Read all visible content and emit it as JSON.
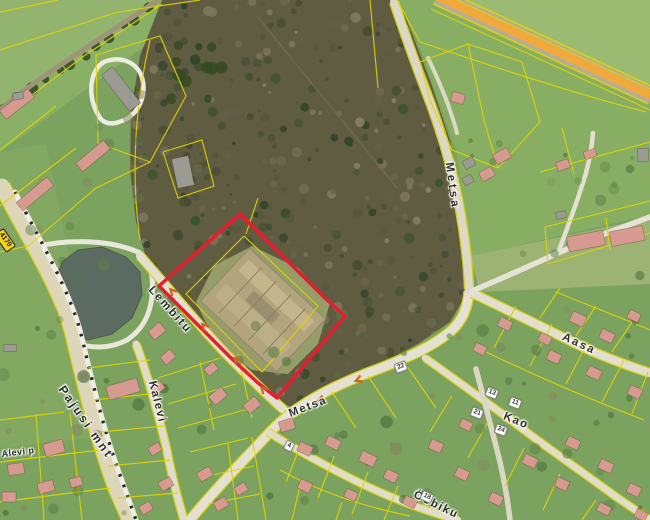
{
  "colors": {
    "base": "#7ba25e",
    "forest": "#5f5c42",
    "pond": "#5c6b62",
    "cadastral": "#e0d400",
    "highlight": "#ea1b2d",
    "road": "#e2dfd0",
    "hwy_orange": "#f1a93c",
    "house": "#d79a90",
    "barn": "#9b9b93"
  },
  "street_labels": [
    {
      "text": "Lembitu",
      "x": 170,
      "y": 310,
      "rot": 48,
      "ls": 2
    },
    {
      "text": "Kalevi",
      "x": 157,
      "y": 402,
      "rot": 76,
      "ls": 1.5
    },
    {
      "text": "Pajusi mnt",
      "x": 86,
      "y": 422,
      "rot": 55,
      "ls": 2.5,
      "fs": 12
    },
    {
      "text": "Metsa",
      "x": 452,
      "y": 186,
      "rot": 82,
      "ls": 3
    },
    {
      "text": "Metsa",
      "x": 308,
      "y": 407,
      "rot": -21,
      "ls": 1.5
    },
    {
      "text": "Aasa",
      "x": 579,
      "y": 344,
      "rot": 25,
      "ls": 2
    },
    {
      "text": "Kao",
      "x": 516,
      "y": 421,
      "rot": 22,
      "ls": 1.5
    },
    {
      "text": "Ööbiku",
      "x": 436,
      "y": 505,
      "rot": 26,
      "ls": 1.5
    },
    {
      "text": "Alevi p",
      "x": 18,
      "y": 452,
      "rot": -7,
      "ls": 0.5,
      "fs": 9
    }
  ],
  "road_shield": {
    "text": "4170",
    "x": 5,
    "y": 240,
    "rot": 55
  },
  "house_numbers": [
    {
      "text": "22",
      "x": 401,
      "y": 367,
      "rot": -20
    },
    {
      "text": "13",
      "x": 492,
      "y": 393,
      "rot": 20
    },
    {
      "text": "11",
      "x": 515,
      "y": 403,
      "rot": 20
    },
    {
      "text": "21",
      "x": 477,
      "y": 413,
      "rot": 20
    },
    {
      "text": "24",
      "x": 501,
      "y": 430,
      "rot": 20
    },
    {
      "text": "18",
      "x": 427,
      "y": 497,
      "rot": 25
    },
    {
      "text": "4",
      "x": 289,
      "y": 446,
      "rot": 25
    }
  ],
  "highlighted_parcel": {
    "outline_color": "#ea1b2d",
    "points": "240,214 327,300 345,316 277,398 258,383 231,358 181,308 159,286"
  },
  "geometry": {
    "forest": "162,0 398,0 410,28 432,86 450,140 462,205 468,255 470,288 450,322 418,344 384,362 348,377 314,394 292,407 280,403 262,388 234,361 182,308 158,284 146,258 136,222 130,170 131,112 140,56",
    "pond": "62,262 78,250 102,247 126,257 140,272 142,295 132,318 112,334 88,340 68,332 57,312 54,285",
    "clearing": "196,302 214,266 252,246 298,268 330,303 318,344 288,374 252,370 216,344",
    "ruin": {
      "cx": 263,
      "cy": 310,
      "rot": 43
    },
    "hwy": "M 437,-4 L 652,96",
    "pajusi_dash": "M 15,192 C 42,244 68,288 80,330 C 90,370 102,428 124,486 L 136,520",
    "fields": [
      {
        "pts": "0,0 160,0 122,34 60,70 0,106",
        "fill": "#93b46e"
      },
      {
        "pts": "0,106 60,70 122,34 160,0 204,0 150,42 88,88 28,132 0,152",
        "fill": "#8ab066"
      },
      {
        "pts": "398,0 650,0 650,215 472,256 456,150 420,48",
        "fill": "#87ae63"
      },
      {
        "pts": "441,0 650,0 650,94",
        "fill": "#9abb71"
      },
      {
        "pts": "470,256 650,218 650,284 480,292",
        "fill": "#9db373"
      },
      {
        "pts": "0,152 46,144 84,330 92,380 104,436 0,448",
        "fill": "#83a861"
      }
    ],
    "roads": [
      {
        "id": "pond-loop",
        "d": "M 28,248 C 70,238 110,240 138,252 C 150,258 154,276 152,296 C 150,316 142,330 127,340 C 110,349 90,349 74,342",
        "w": 5,
        "c": "#e9e6da"
      },
      {
        "id": "track-topleft",
        "d": "M 158,0 L 80,52 C 50,72 20,92 0,110",
        "w": 5,
        "c": "#9e9478"
      },
      {
        "id": "barn-loop",
        "d": "M 100,118 C 86,96 90,70 104,62 C 120,55 140,62 143,82 C 146,102 134,118 119,122 C 110,125 104,123 100,118",
        "w": 4.5,
        "c": "#eeece2"
      },
      {
        "id": "pajusi-mnt",
        "d": "M 2,186 C 30,240 60,286 72,330 C 82,370 94,428 116,488 L 130,520",
        "w": 15,
        "c": "#ddd6b8",
        "u": 1
      },
      {
        "id": "pajusi-path",
        "d": "M 15,192 C 42,244 68,288 80,330 C 90,370 102,428 124,486 L 136,520",
        "w": 5,
        "c": "#f0eee4"
      },
      {
        "id": "lembitu",
        "d": "M 140,256 C 162,280 192,318 226,354 C 250,378 266,394 284,410",
        "w": 8,
        "c": "#e2dfd0",
        "u": 1
      },
      {
        "id": "kalevi",
        "d": "M 136,344 C 146,370 156,406 166,446 C 172,478 178,500 184,520",
        "w": 7,
        "c": "#dfdccb",
        "u": 1
      },
      {
        "id": "metsa-south",
        "d": "M 190,520 C 218,486 246,458 272,430 C 298,404 330,388 365,374 C 400,361 432,348 452,330 C 463,320 468,306 469,291",
        "w": 9,
        "c": "#e4e1d2",
        "u": 1
      },
      {
        "id": "metsa-north",
        "d": "M 394,2 C 402,26 414,60 427,94 C 440,128 451,164 458,199 C 464,230 468,262 469,289",
        "w": 8,
        "c": "#dcd8c6",
        "u": 1
      },
      {
        "id": "aasa",
        "d": "M 472,293 C 510,311 550,331 589,350 C 612,360 632,367 650,373",
        "w": 8,
        "c": "#e2dfd0",
        "u": 1
      },
      {
        "id": "kao",
        "d": "M 425,358 C 452,377 482,399 512,421 C 546,447 581,471 615,496 C 628,505 640,513 650,520",
        "w": 6.5,
        "c": "#e0ddcd",
        "u": 1
      },
      {
        "id": "kao-cross",
        "d": "M 476,369 C 483,396 492,430 500,462 C 505,484 508,502 510,520",
        "w": 5.5,
        "c": "#dbd7c5"
      },
      {
        "id": "oobiku",
        "d": "M 268,432 C 292,447 320,463 350,478 C 385,496 425,511 458,520",
        "w": 6.5,
        "c": "#e0ddcd",
        "u": 1
      },
      {
        "id": "rightmid",
        "d": "M 472,291 C 500,279 530,266 558,253 C 590,239 620,228 650,217",
        "w": 5.5,
        "c": "#e6e3d6"
      },
      {
        "id": "rightmid-stub",
        "d": "M 558,253 C 568,226 578,200 586,173 C 590,158 592,146 593,133",
        "w": 4.5,
        "c": "#e3e0d2"
      },
      {
        "id": "ne-drive",
        "d": "M 428,58 C 441,85 451,110 457,133",
        "w": 4,
        "c": "#ddd9c8"
      }
    ],
    "parcel_lines": [
      "M 0,50 L 118,12 L 200,0",
      "M 0,12 L 58,0",
      "M 96,55 L 160,36 L 186,96 L 150,162 L 98,143 L 96,55",
      "M 163,152 L 202,140 L 214,186 L 178,198 L 163,152",
      "M 0,150 L 56,106",
      "M 0,206 L 76,148",
      "M 28,246 L 96,188 L 150,162",
      "M 0,252 L 28,246",
      "M 150,40 C 136,100 130,170 140,240",
      "M 162,4 L 84,56 L 4,116",
      "M 420,42 C 492,66 562,90 646,112",
      "M 398,2 L 420,42",
      "M 431,9 L 650,110",
      "M 444,-6 L 650,89",
      "M 545,227 L 650,201",
      "M 548,264 L 650,233",
      "M 545,227 L 548,264",
      "M 606,218 L 610,250",
      "M 540,172 L 650,142",
      "M 562,128 L 574,174",
      "M 420,62 L 468,44 L 522,62 L 540,122 L 498,168 L 452,150 L 430,100 L 420,62",
      "M 468,44 L 484,120 L 498,168",
      "M 244,236 L 318,306 L 262,372 L 186,294 L 244,236",
      "M 246,234 L 258,198",
      "M 370,0 L 378,88",
      "M 88,368 L 150,360",
      "M 94,400 L 158,393",
      "M 100,432 L 164,426",
      "M 108,466 L 170,460",
      "M 118,498 L 178,493",
      "M 0,420 L 64,412",
      "M 0,462 L 100,450",
      "M 0,502 L 110,488",
      "M 36,414 L 44,520",
      "M 70,413 L 82,520",
      "M 190,452 L 248,438",
      "M 198,478 L 254,466",
      "M 208,504 L 260,494",
      "M 228,444 L 238,520",
      "M 252,437 L 266,520",
      "M 158,378 L 220,358",
      "M 168,404 L 236,384",
      "M 178,428 L 252,408",
      "M 200,362 L 214,430",
      "M 238,354 L 252,418",
      "M 302,442 L 286,482",
      "M 334,456 L 318,498",
      "M 368,472 L 352,514",
      "M 398,486 L 384,520",
      "M 280,470 C 320,492 362,506 410,516",
      "M 332,392 L 356,428",
      "M 368,376 L 396,418",
      "M 404,362 L 436,408",
      "M 452,396 L 430,432",
      "M 488,422 L 468,458",
      "M 524,448 L 505,486",
      "M 560,474 L 543,510",
      "M 596,500 L 582,520",
      "M 516,306 L 494,348",
      "M 552,324 L 530,366",
      "M 588,342 L 566,384",
      "M 624,360 L 602,402",
      "M 648,372 L 632,414",
      "M 486,352 C 540,378 592,400 644,420",
      "M 540,318 L 560,288",
      "M 576,336 L 596,306",
      "M 612,352 L 632,322",
      "M 556,292 C 590,306 622,318 650,330",
      "M 300,486 L 292,520",
      "M 342,502 L 336,520"
    ],
    "buildings": [
      [
        17,
        104,
        36,
        11,
        -38,
        "p"
      ],
      [
        93,
        156,
        36,
        11,
        -40,
        "p"
      ],
      [
        35,
        194,
        40,
        11,
        -40,
        "p"
      ],
      [
        121,
        89,
        46,
        14,
        52,
        "g"
      ],
      [
        183,
        172,
        17,
        30,
        -12,
        "g"
      ],
      [
        123,
        389,
        32,
        14,
        -16,
        "p"
      ],
      [
        18,
        96,
        11,
        7,
        -10,
        "g"
      ],
      [
        10,
        348,
        13,
        7,
        0,
        "g"
      ],
      [
        502,
        156,
        16,
        11,
        -28,
        "p"
      ],
      [
        487,
        174,
        14,
        10,
        -28,
        "p"
      ],
      [
        469,
        163,
        11,
        9,
        -28,
        "g"
      ],
      [
        468,
        180,
        10,
        8,
        -28,
        "g"
      ],
      [
        458,
        98,
        13,
        10,
        15,
        "p"
      ],
      [
        586,
        241,
        37,
        15,
        -11,
        "p"
      ],
      [
        627,
        236,
        34,
        15,
        -11,
        "p"
      ],
      [
        561,
        215,
        10,
        7,
        -11,
        "g"
      ],
      [
        563,
        165,
        13,
        9,
        -18,
        "p"
      ],
      [
        590,
        154,
        12,
        8,
        -18,
        "p"
      ],
      [
        643,
        155,
        11,
        13,
        0,
        "g"
      ],
      [
        157,
        331,
        15,
        11,
        -40,
        "p"
      ],
      [
        168,
        357,
        13,
        10,
        -40,
        "p"
      ],
      [
        211,
        369,
        12,
        9,
        -40,
        "p"
      ],
      [
        158,
        388,
        12,
        9,
        -40,
        "p"
      ],
      [
        218,
        396,
        16,
        11,
        -40,
        "p"
      ],
      [
        252,
        405,
        15,
        11,
        -40,
        "p"
      ],
      [
        287,
        425,
        15,
        11,
        -18,
        "p"
      ],
      [
        305,
        449,
        14,
        10,
        25,
        "p"
      ],
      [
        333,
        443,
        14,
        10,
        25,
        "p"
      ],
      [
        368,
        459,
        16,
        11,
        25,
        "p"
      ],
      [
        391,
        476,
        13,
        10,
        25,
        "p"
      ],
      [
        305,
        486,
        13,
        10,
        25,
        "p"
      ],
      [
        351,
        495,
        12,
        9,
        25,
        "p"
      ],
      [
        410,
        502,
        13,
        9,
        25,
        "p"
      ],
      [
        436,
        446,
        13,
        10,
        25,
        "p"
      ],
      [
        462,
        474,
        13,
        10,
        25,
        "p"
      ],
      [
        496,
        499,
        13,
        10,
        25,
        "p"
      ],
      [
        466,
        425,
        12,
        9,
        25,
        "p"
      ],
      [
        530,
        461,
        14,
        10,
        25,
        "p"
      ],
      [
        562,
        484,
        13,
        10,
        25,
        "p"
      ],
      [
        573,
        443,
        13,
        10,
        25,
        "p"
      ],
      [
        606,
        466,
        14,
        10,
        25,
        "p"
      ],
      [
        634,
        490,
        13,
        10,
        25,
        "p"
      ],
      [
        578,
        319,
        15,
        11,
        25,
        "p"
      ],
      [
        607,
        336,
        14,
        10,
        25,
        "p"
      ],
      [
        554,
        357,
        13,
        10,
        25,
        "p"
      ],
      [
        594,
        373,
        14,
        10,
        25,
        "p"
      ],
      [
        635,
        392,
        13,
        10,
        25,
        "p"
      ],
      [
        545,
        339,
        12,
        9,
        25,
        "p"
      ],
      [
        634,
        316,
        12,
        9,
        25,
        "p"
      ],
      [
        505,
        324,
        13,
        10,
        25,
        "p"
      ],
      [
        480,
        349,
        12,
        9,
        25,
        "p"
      ],
      [
        604,
        509,
        13,
        9,
        25,
        "p"
      ],
      [
        641,
        515,
        12,
        9,
        25,
        "p"
      ],
      [
        16,
        469,
        16,
        11,
        -8,
        "p"
      ],
      [
        54,
        448,
        20,
        13,
        -15,
        "p"
      ],
      [
        46,
        487,
        16,
        11,
        -15,
        "p"
      ],
      [
        9,
        497,
        14,
        10,
        0,
        "p"
      ],
      [
        76,
        482,
        12,
        9,
        -15,
        "p"
      ],
      [
        155,
        449,
        12,
        9,
        -30,
        "p"
      ],
      [
        166,
        484,
        13,
        10,
        -30,
        "p"
      ],
      [
        146,
        508,
        12,
        9,
        -30,
        "p"
      ],
      [
        205,
        474,
        14,
        10,
        -30,
        "p"
      ],
      [
        221,
        504,
        13,
        10,
        -30,
        "p"
      ],
      [
        241,
        489,
        12,
        9,
        -30,
        "p"
      ]
    ],
    "chevrons": [
      {
        "x": 172,
        "y": 291,
        "r": 228
      },
      {
        "x": 204,
        "y": 326,
        "r": 228
      },
      {
        "x": 236,
        "y": 360,
        "r": 228
      },
      {
        "x": 263,
        "y": 389,
        "r": 228
      },
      {
        "x": 320,
        "y": 400,
        "r": 158
      },
      {
        "x": 358,
        "y": 380,
        "r": 158
      }
    ]
  }
}
